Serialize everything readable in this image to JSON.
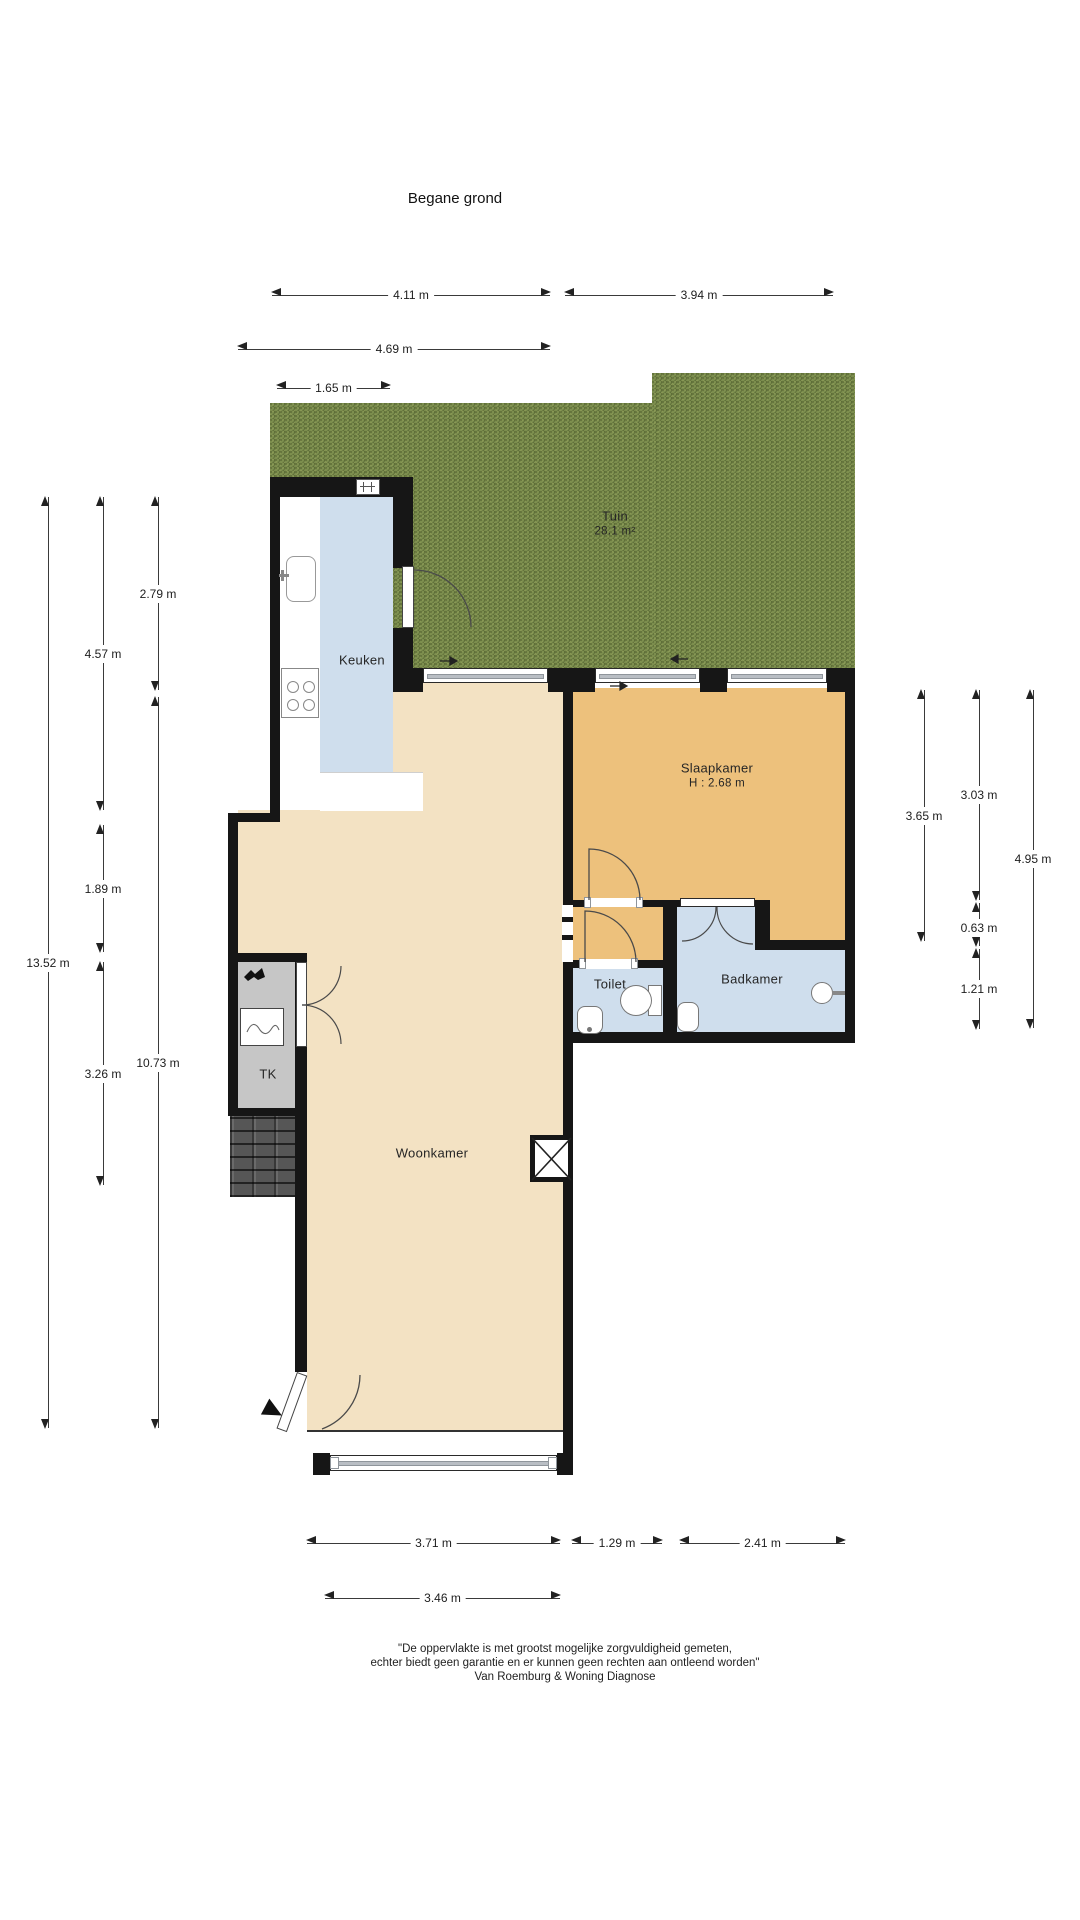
{
  "title": "Begane grond",
  "rooms": {
    "tuin": {
      "name": "Tuin",
      "area": "28.1 m²"
    },
    "keuken": {
      "name": "Keuken"
    },
    "slaapkamer": {
      "name": "Slaapkamer",
      "height": "H : 2.68 m"
    },
    "toilet": {
      "name": "Toilet"
    },
    "badkamer": {
      "name": "Badkamer"
    },
    "tk": {
      "name": "TK"
    },
    "woonkamer": {
      "name": "Woonkamer"
    }
  },
  "dims": {
    "d411": "4.11 m",
    "d394": "3.94 m",
    "d469": "4.69 m",
    "d165": "1.65 m",
    "d371": "3.71 m",
    "d129": "1.29 m",
    "d241": "2.41 m",
    "d346": "3.46 m",
    "d1352": "13.52 m",
    "d457": "4.57 m",
    "d189": "1.89 m",
    "d326": "3.26 m",
    "d279": "2.79 m",
    "d1073": "10.73 m",
    "d365": "3.65 m",
    "d303": "3.03 m",
    "d063": "0.63 m",
    "d121": "1.21 m",
    "d495": "4.95 m"
  },
  "footer": {
    "line1": "\"De oppervlakte is met grootst mogelijke zorgvuldigheid gemeten,",
    "line2": "echter biedt geen garantie en er kunnen geen rechten aan ontleend worden\"",
    "line3": "Van Roemburg & Woning Diagnose"
  },
  "colors": {
    "wall": "#161616",
    "garden": "#7c8e4e",
    "living_floor": "#f3e2c3",
    "bedroom_floor": "#edc17c",
    "wet_floor": "#cfdeed",
    "closet_floor": "#c6c6c6"
  }
}
